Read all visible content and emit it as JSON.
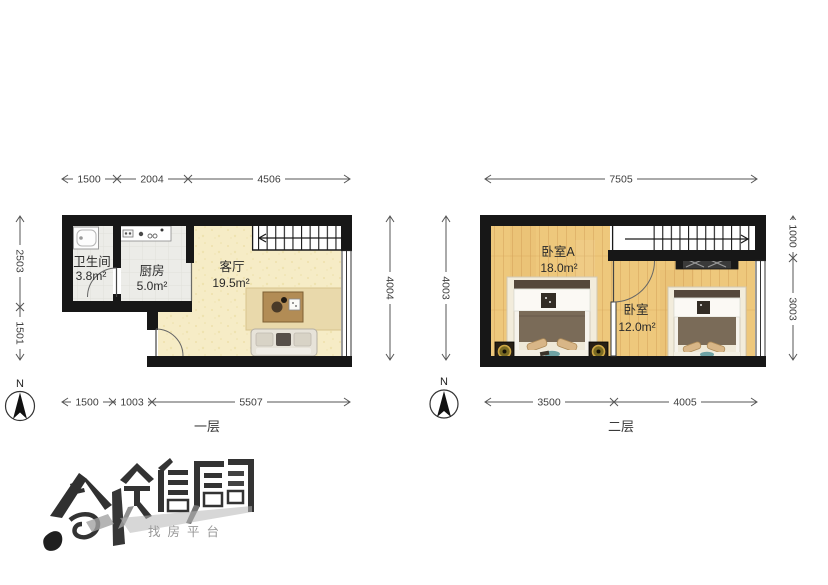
{
  "floor1": {
    "label": "一层",
    "dims": {
      "top": [
        "1500",
        "2004",
        "4506"
      ],
      "left": [
        "2503",
        "1501"
      ],
      "right": [
        "4004"
      ],
      "bottom": [
        "1500",
        "1003",
        "5507"
      ]
    },
    "rooms": {
      "bathroom": {
        "name": "卫生间",
        "area": "3.8m²"
      },
      "kitchen": {
        "name": "厨房",
        "area": "5.0m²"
      },
      "living": {
        "name": "客厅",
        "area": "19.5m²"
      }
    }
  },
  "floor2": {
    "label": "二层",
    "dims": {
      "top": [
        "7505"
      ],
      "left": [
        "4003"
      ],
      "right": [
        "1000",
        "3003"
      ],
      "bottom": [
        "3500",
        "4005"
      ]
    },
    "rooms": {
      "bedroomA": {
        "name": "卧室A",
        "area": "18.0m²"
      },
      "bedroom": {
        "name": "卧室",
        "area": "12.0m²"
      }
    }
  },
  "compass": {
    "north": "N"
  },
  "watermark": {
    "slogan": "找房平台"
  },
  "colors": {
    "wall": "#171717",
    "living_floor": "#f6ecc6",
    "tile_floor": "#ececе8",
    "wood_floor": "#eec87c",
    "rug": "#e9d9ab",
    "blanket": "#7a6b58",
    "dimension_text": "#3d3d3d"
  }
}
